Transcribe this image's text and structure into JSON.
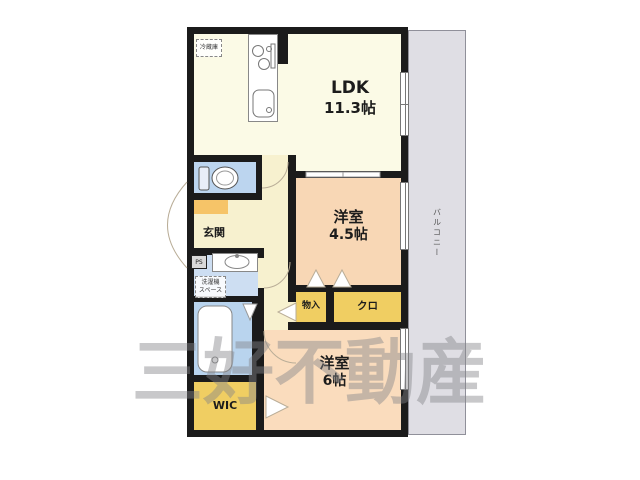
{
  "watermark": "三好不動産",
  "balcony": {
    "label": "バルコニー"
  },
  "rooms": {
    "ldk": {
      "name": "LDK",
      "size": "11.3帖"
    },
    "bedroom_45": {
      "name": "洋室",
      "size": "4.5帖"
    },
    "bedroom_6": {
      "name": "洋室",
      "size": "6帖"
    },
    "entrance": {
      "label": "玄関"
    },
    "wic": {
      "label": "WIC"
    },
    "storage": {
      "label": "物入"
    },
    "closet": {
      "label": "クロ"
    }
  },
  "fixtures": {
    "refrigerator": {
      "label": "冷蔵庫"
    },
    "washer_space": {
      "line1": "洗濯機",
      "line2": "スペース"
    },
    "pipe_space": {
      "label": "PS"
    }
  },
  "palette": {
    "wall": "#1b1b1b",
    "ldk_fill": "#fbfae6",
    "hall_fill": "#f7f1cf",
    "bedroom45_fill": "#f8d7b5",
    "bedroom6_fill": "#fadcbd",
    "closet_fill": "#f0ce62",
    "entrance_step": "#f6c468",
    "toilet_fill": "#bcd5ef",
    "washroom_fill": "#cddef2",
    "bath_fill": "#b9d4ee",
    "balcony_fill": "#dfdee4",
    "watermark_gray": "#84848a"
  }
}
